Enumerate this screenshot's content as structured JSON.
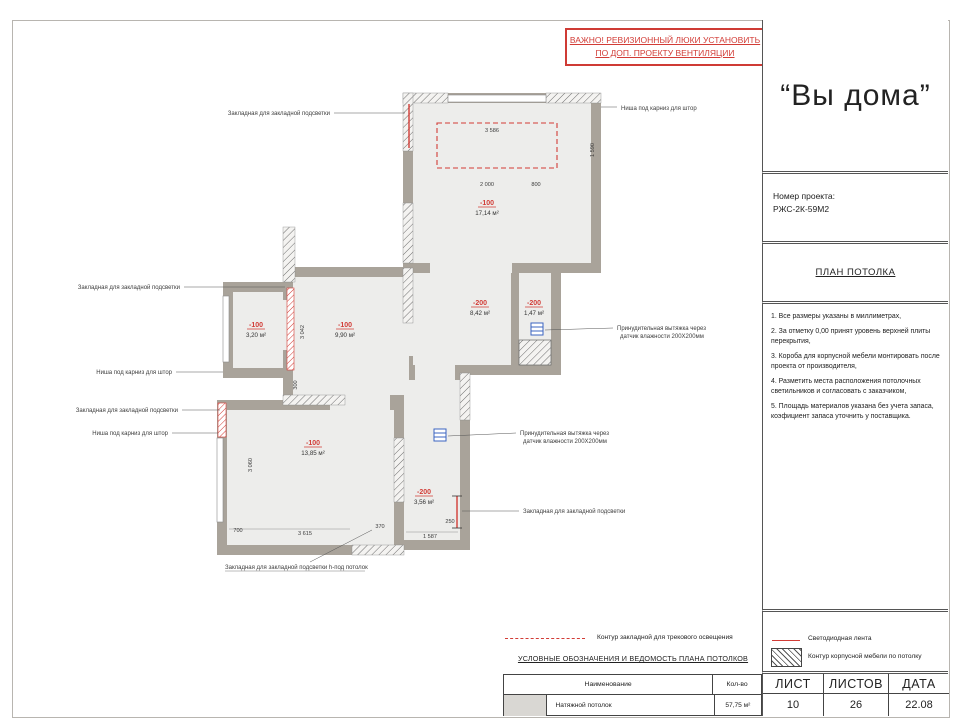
{
  "colors": {
    "accent_red": "#d23c36",
    "wall_gray": "#a9a39a",
    "interior_gray": "#ededeb",
    "vent_blue": "#3b64c0"
  },
  "warning": {
    "line1": "ВАЖНО! РЕВИЗИОННЫЙ ЛЮКИ УСТАНОВИТЬ",
    "line2": "ПО ДОП. ПРОЕКТУ ВЕНТИЛЯЦИИ"
  },
  "title_block": {
    "logo": "“Вы дома”",
    "project_label": "Номер проекта:",
    "project_number": "РЖС-2К-59М2",
    "drawing_title": "ПЛАН ПОТОЛКА",
    "notes": [
      "1. Все размеры указаны в миллиметрах,",
      "2. За отметку 0,00 принят уровень верхней плиты перекрытия,",
      "3. Короба для корпусной мебели монтировать после проекта от производителя,",
      "4. Разметить места расположения потолочных светильников и согласовать с заказчиком,",
      "5. Площадь материалов указана без учета запаса, коэфициент запаса уточнить у поставщика."
    ]
  },
  "plan": {
    "rooms": [
      {
        "elev": "-100",
        "area": "17,14 м²"
      },
      {
        "elev": "-200",
        "area": "8,42 м²"
      },
      {
        "elev": "-200",
        "area": "1,47 м²"
      },
      {
        "elev": "-100",
        "area": "3,20 м²"
      },
      {
        "elev": "-100",
        "area": "9,90 м²"
      },
      {
        "elev": "-100",
        "area": "13,85 м²"
      },
      {
        "elev": "-200",
        "area": "3,56 м²"
      }
    ],
    "dims": [
      "3 586",
      "1 590",
      "2 000",
      "800",
      "3 042",
      "300",
      "3 060",
      "700",
      "3 615",
      "370",
      "1 587",
      "250"
    ],
    "callouts": {
      "c1": "Закладная для закладной подсветки",
      "c2": "Ниша под карниз для штор",
      "c3": "Закладная для закладной подсветки",
      "c4": "Ниша под карниз для штор",
      "c5": "Закладная для закладной подсветки",
      "c6": "Ниша под карниз для штор",
      "c7a": "Принудительная вытяжка через",
      "c7b": "датчик влажности 200Х200мм",
      "c8a": "Принудительная вытяжка через",
      "c8b": "датчик влажности 200Х200мм",
      "c9": "Закладная для закладной подсветки",
      "c10": "Закладная для закладной подсветки h-под потолок"
    }
  },
  "legend": {
    "track": "Контур закладной для трекового освещения",
    "led": "Светодиодная лента",
    "furniture": "Контур корпусной мебели по потолку",
    "section_title": "УСЛОВНЫЕ ОБОЗНАЧЕНИЯ И ВЕДОМОСТЬ ПЛАНА ПОТОЛКОВ"
  },
  "table": {
    "col_name": "Наименование",
    "col_qty": "Кол-во",
    "row_name": "Натяжной потолок",
    "row_qty": "57,75 м²"
  },
  "sheet": {
    "sheet_label": "ЛИСТ",
    "sheets_label": "ЛИСТОВ",
    "date_label": "ДАТА",
    "sheet": "10",
    "sheets": "26",
    "date": "22.08"
  }
}
